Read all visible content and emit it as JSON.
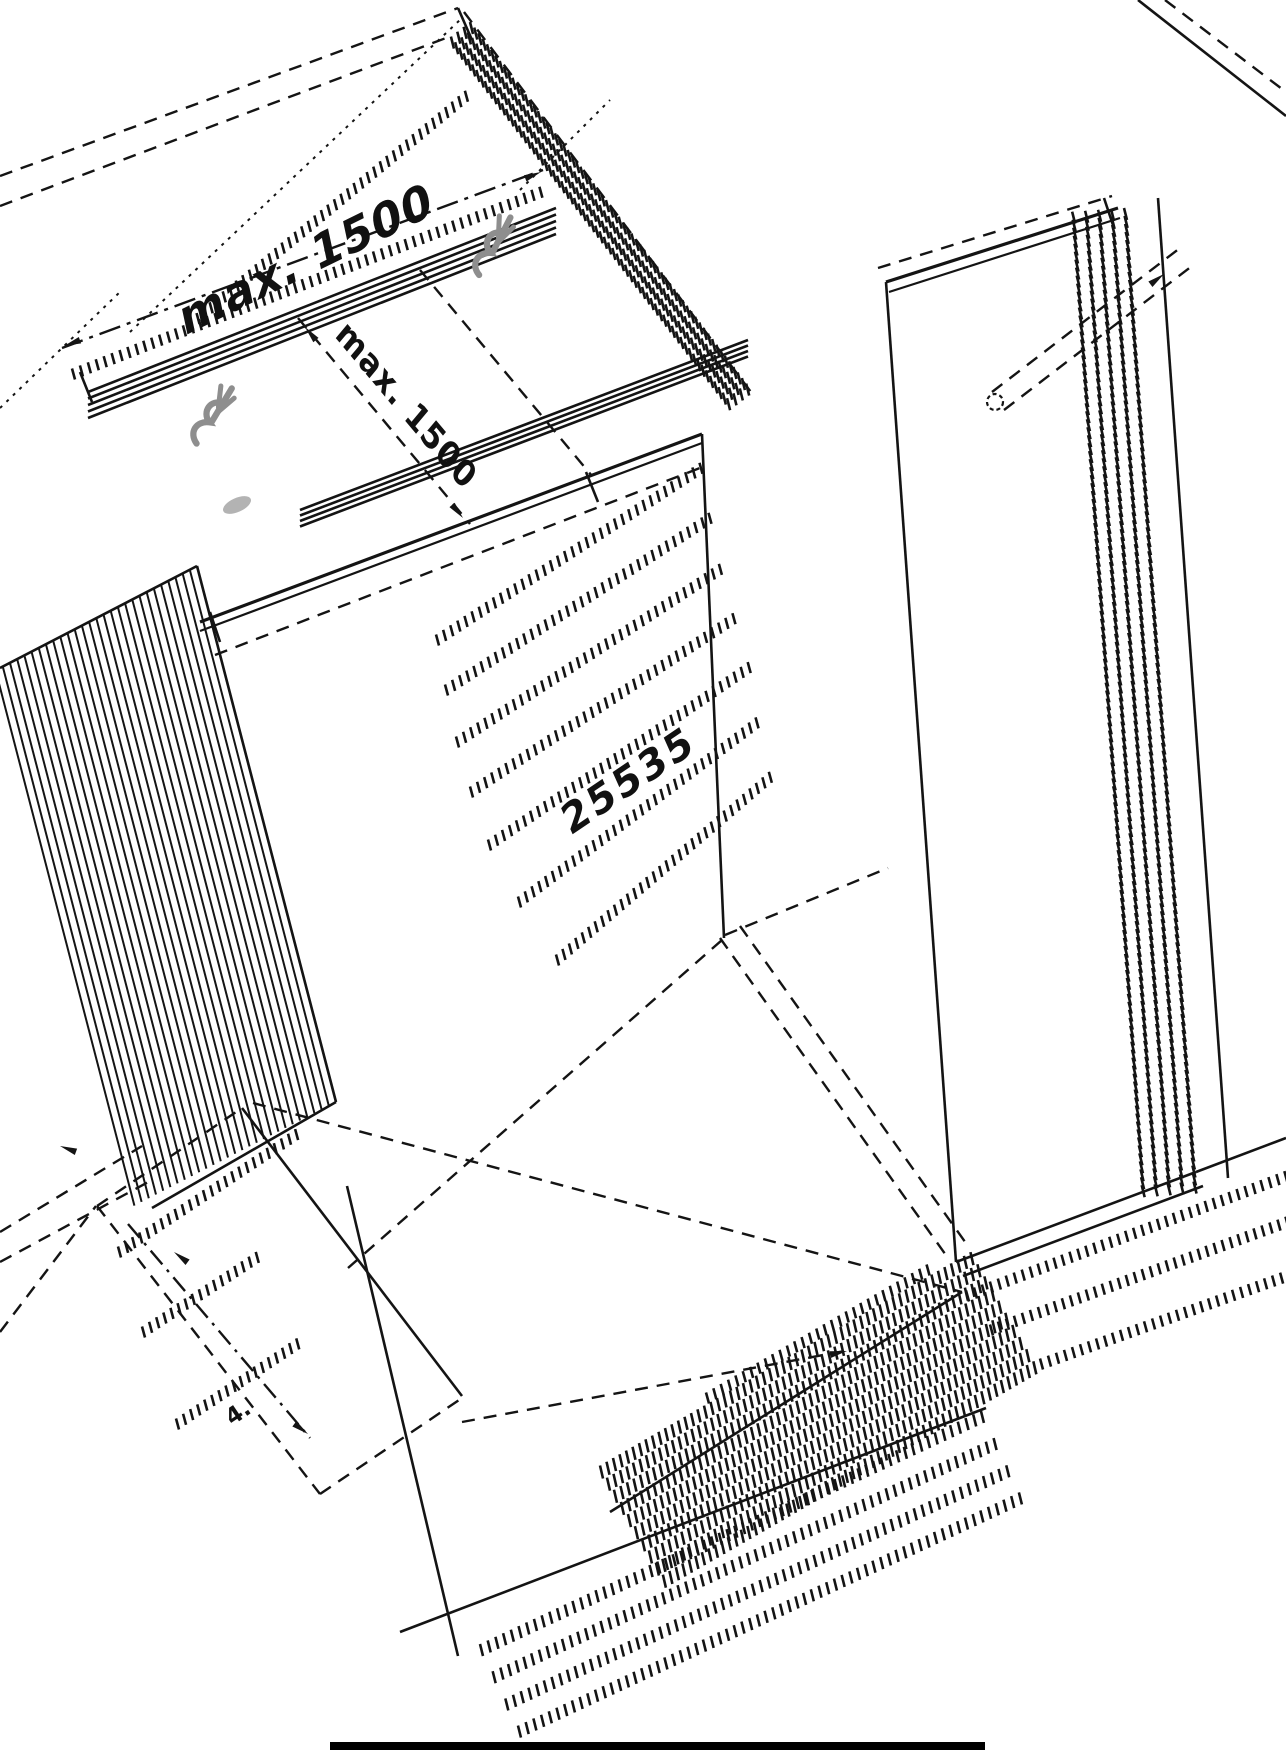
{
  "diagram": {
    "labels": {
      "max_spacing_top": "max. 1500",
      "max_spacing_side": "max. 1500",
      "part_number": "25535",
      "step_index": "4."
    },
    "colors": {
      "line": "#141414",
      "screw_gray": "#8e8e8e",
      "background": "#ffffff"
    },
    "icons": {
      "screw": "screw-icon",
      "arrowhead": "arrowhead-icon"
    }
  }
}
